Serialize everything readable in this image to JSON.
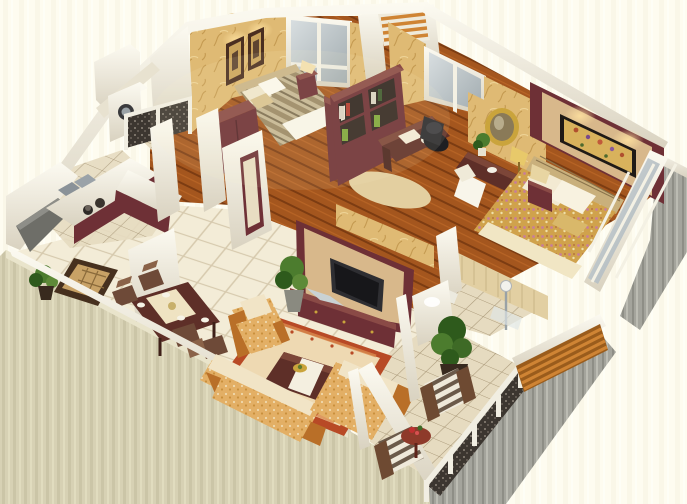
{
  "scene": {
    "type": "3d-isometric-floor-plan-render",
    "description": "Cutaway 3D rendering of a three-room apartment floor plan viewed from above at an angle",
    "rooms": [
      {
        "name": "second-bedroom",
        "furniture": [
          "striped-double-bed",
          "rattan-headboard",
          "two-framed-pictures",
          "wall-lamps",
          "nightstand",
          "table-lamp",
          "window",
          "maroon-wardrobe",
          "bookshelf-back"
        ]
      },
      {
        "name": "study",
        "furniture": [
          "maroon-bookshelf",
          "writing-desk",
          "black-office-chair",
          "desk-lamp",
          "area-rug",
          "window"
        ]
      },
      {
        "name": "hallway-dressing-area",
        "furniture": [
          "round-gold-mirror",
          "console-table",
          "white-chair",
          "table-lamp",
          "small-plant"
        ]
      },
      {
        "name": "master-bedroom",
        "furniture": [
          "maroon-headboard-feature-wall",
          "floral-painting",
          "floral-double-bed",
          "cream-pillows",
          "nightstand",
          "table-lamp",
          "floor-to-ceiling-window"
        ]
      },
      {
        "name": "kitchen",
        "furniture": [
          "l-shaped-counter",
          "double-sink",
          "stove-with-pots",
          "maroon-cabinets",
          "service-balcony-counter"
        ]
      },
      {
        "name": "utility-balcony",
        "furniture": [
          "washing-machine",
          "white-cabinet",
          "ornate-metal-railing",
          "tile-floor"
        ]
      },
      {
        "name": "dining-area",
        "furniture": [
          "dark-wood-dining-table",
          "table-runner",
          "four-chairs",
          "place-settings",
          "entry-mat",
          "potted-plant"
        ]
      },
      {
        "name": "living-room",
        "furniture": [
          "tv-feature-wall",
          "flat-screen-tv",
          "tv-cabinet",
          "fabric-sofa-set",
          "armchair",
          "coffee-table",
          "fruit-bowl",
          "bordered-area-rug",
          "potted-plants",
          "white-door-frames"
        ]
      },
      {
        "name": "bathroom",
        "furniture": [
          "toilet",
          "shower-column",
          "vanity",
          "beige-tiled-walls"
        ]
      },
      {
        "name": "balcony",
        "furniture": [
          "two-striped-armchairs",
          "round-red-side-table",
          "flower-pot",
          "large-potted-plant",
          "ornate-railing-with-white-posts",
          "wooden-slat-screen",
          "diagonal-tile-floor"
        ]
      }
    ],
    "counts": {
      "balcony_railing_posts": 5,
      "slat_screen_boards": 5,
      "master_window_panes": 4,
      "alcove_slats": 4
    }
  },
  "palette": {
    "bg1": "#fdfbee",
    "bg2": "#f1ecd8",
    "face-beige1": "#d7d1b4",
    "face-beige2": "#c7c1a2",
    "face-gray1": "#a4a49c",
    "face-gray2": "#8e8e86",
    "face-gray3": "#c0c0b8",
    "wall-white": "#f4f1e4",
    "wall-white-lt": "#fcfaf1",
    "wall-shadow": "#d9d2c0",
    "paper1": "#dfba74",
    "paper2": "#c3954a",
    "paper-lt": "#f1d99f",
    "paper-leaf": "#b2853a",
    "wood1": "#a4561e",
    "wood2": "#7c3c12",
    "wood-lt": "#c06a28",
    "tile1": "#f3ecd7",
    "tile-line": "#d6c9ad",
    "btile1": "#e6dbc0",
    "btile-line": "#a99878",
    "maroon": "#6e3036",
    "maroon-dk": "#522228",
    "maroon-lt": "#8a4a46",
    "tan-panel": "#d8b88b",
    "tv-screen": "#17171a",
    "sofa1": "#e3af65",
    "sofa2": "#f0d9ae",
    "sofa-wood": "#b96f28",
    "rug-border": "#b84a26",
    "rug-inner": "#eed9b2",
    "bed-stripe1": "#9a8866",
    "bed-stripe2": "#c6b795",
    "white-soft": "#f8f5ea",
    "floral1": "#d0a24c",
    "floral2": "#c87e9a",
    "green1": "#4c7c2e",
    "green2": "#2e5a1c",
    "pot": "#382a1e",
    "rail-dark": "#3c3630",
    "rail-white": "#f1eee2",
    "slat": "#cf8434",
    "slat-dk": "#9a5c1c",
    "glass1": "#d8dee0",
    "glass2": "#a2acb0",
    "gold": "#caa43c",
    "red-table": "#8e3a2a"
  }
}
